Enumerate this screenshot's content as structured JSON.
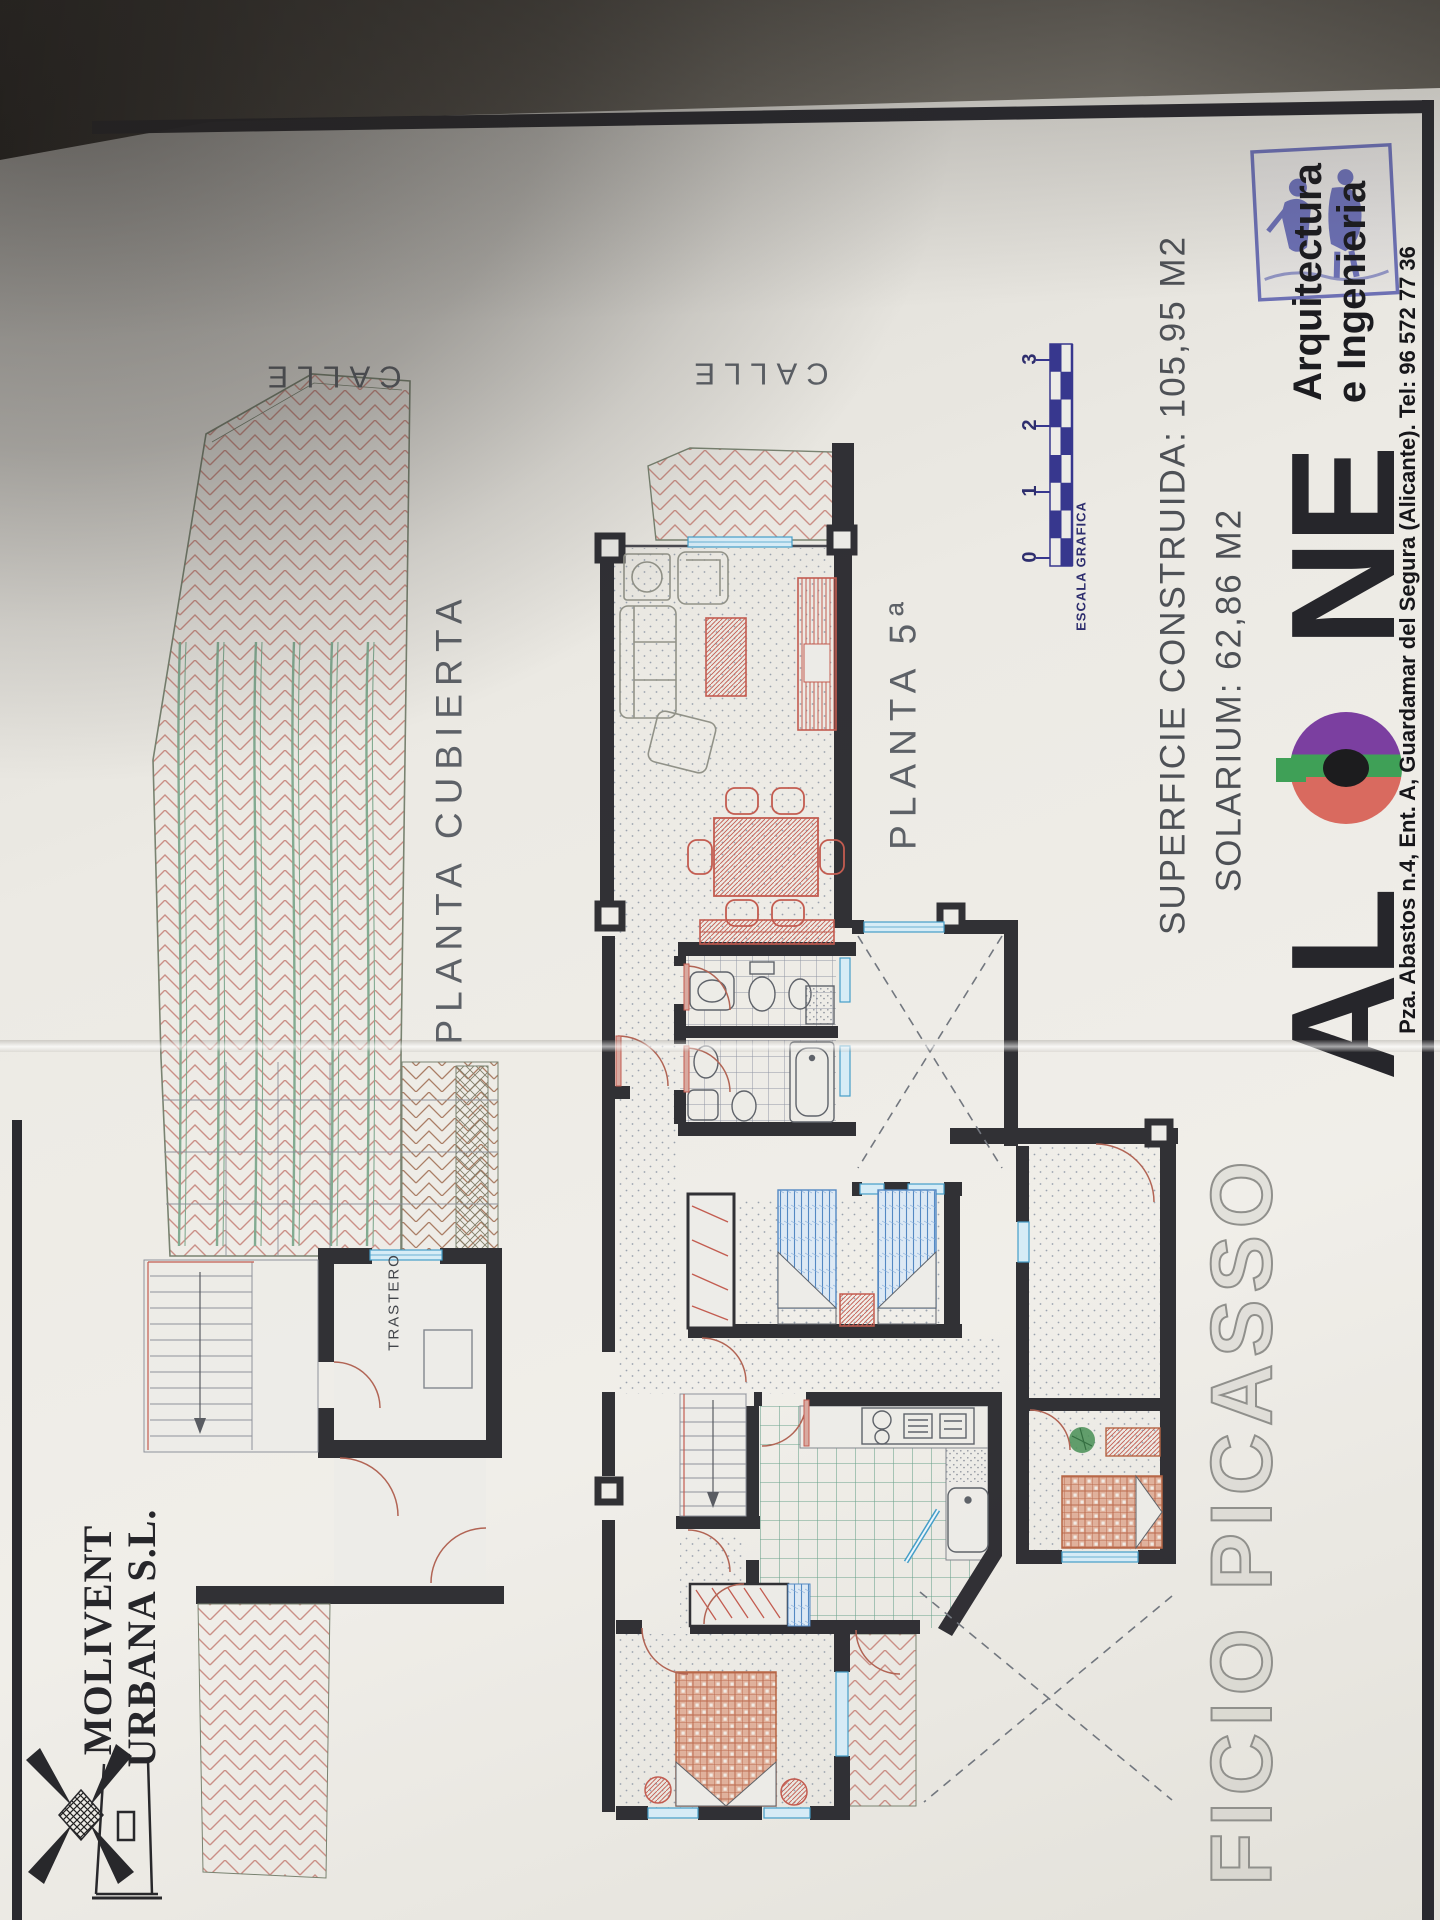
{
  "plan_labels": {
    "calle_left": "CALLE",
    "calle_right": "CALLE",
    "planta_cubierta": "PLANTA CUBIERTA",
    "planta_5": "PLANTA 5ª",
    "trastero": "TRASTERO"
  },
  "measurements": {
    "superficie_line": "SUPERFICIE CONSTRUIDA: 105,95 M2",
    "solarium_line": "SOLARIUM: 62,86 M2"
  },
  "scale_bar": {
    "caption": "ESCALA GRAFICA",
    "ticks": [
      "0",
      "1",
      "2",
      "3"
    ]
  },
  "architect": {
    "wordmark_al": "AL",
    "wordmark_ne": "NE",
    "tagline_line1": "Arquitectura",
    "tagline_line2": "e Ingenieria",
    "address": "Pza. Abastos n.4, Ent. A, Guardamar del Segura (Alicante). Tel: 96 572 77 36"
  },
  "developer": {
    "name_line1": "MOLIVENT",
    "name_line2": "URBANA S.L."
  },
  "project": {
    "title_visible": "FICIO PICASSO"
  },
  "colors": {
    "accent_navy": "#32328c",
    "stamp_blue": "#575cac",
    "plan_red": "#c2584c",
    "plan_blue": "#3f9cc8",
    "plan_green": "#7fa98f",
    "wall_black": "#2b2b30",
    "logo_purple": "#7b3fa0",
    "logo_green": "#3fa057",
    "logo_red": "#d96a5f"
  }
}
